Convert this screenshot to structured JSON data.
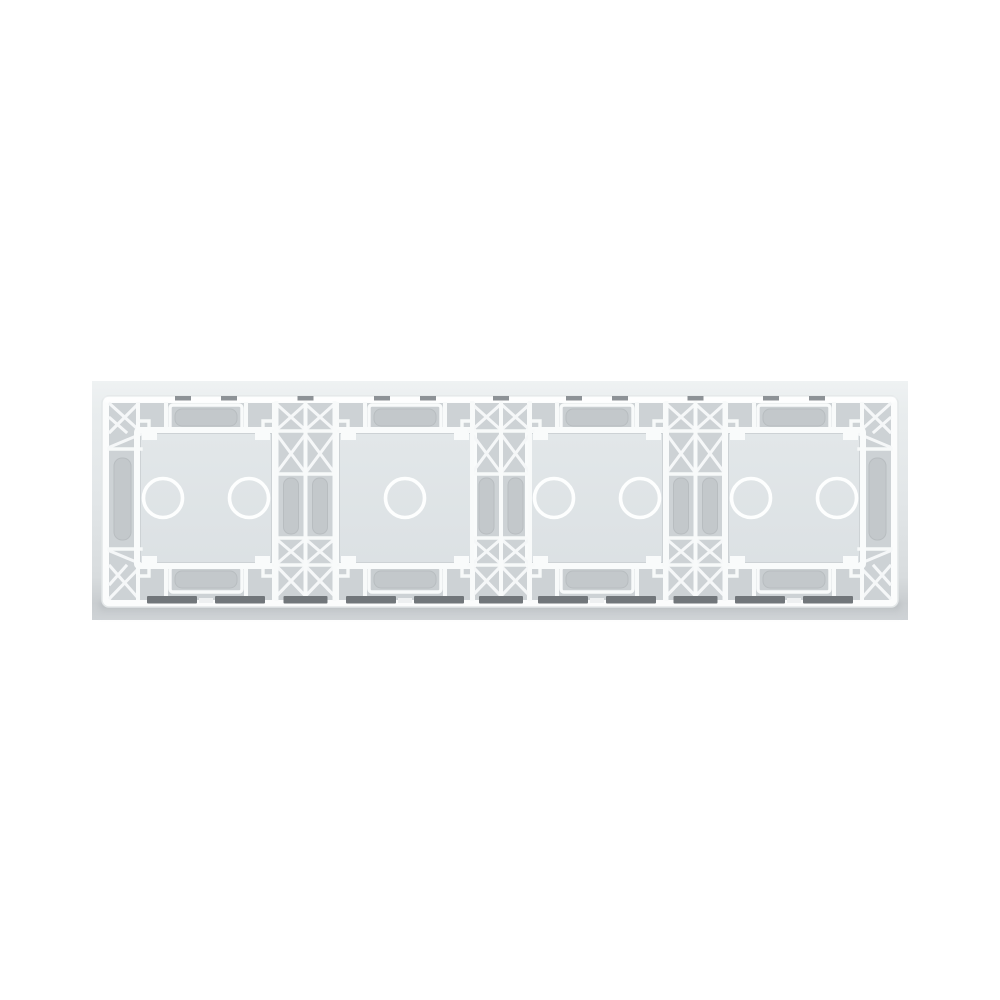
{
  "product": {
    "description": "Rear view of a quadruple glass touch-switch panel frame with white plastic lattice ribbing",
    "modules": [
      {
        "label": "module-1",
        "touch_points": 2
      },
      {
        "label": "module-2",
        "touch_points": 1
      },
      {
        "label": "module-3",
        "touch_points": 2
      },
      {
        "label": "module-4",
        "touch_points": 2
      }
    ],
    "touch_circle": {
      "radius": 19.5,
      "pair_offset": 43,
      "stroke_width": 3.6
    },
    "colors": {
      "page_background": "#ffffff",
      "backdrop_top": "#eff2f3",
      "backdrop_mid": "#e2e6e8",
      "backdrop_bottom": "#cfd3d6",
      "frame_white": "#fbfcfc",
      "recess_gray": "#cdd2d5",
      "glass_light": "#e2e7e9",
      "glass_dark": "#dce1e4",
      "circle_stroke": "#fdfefe",
      "slot_dark": "#71767a"
    }
  }
}
